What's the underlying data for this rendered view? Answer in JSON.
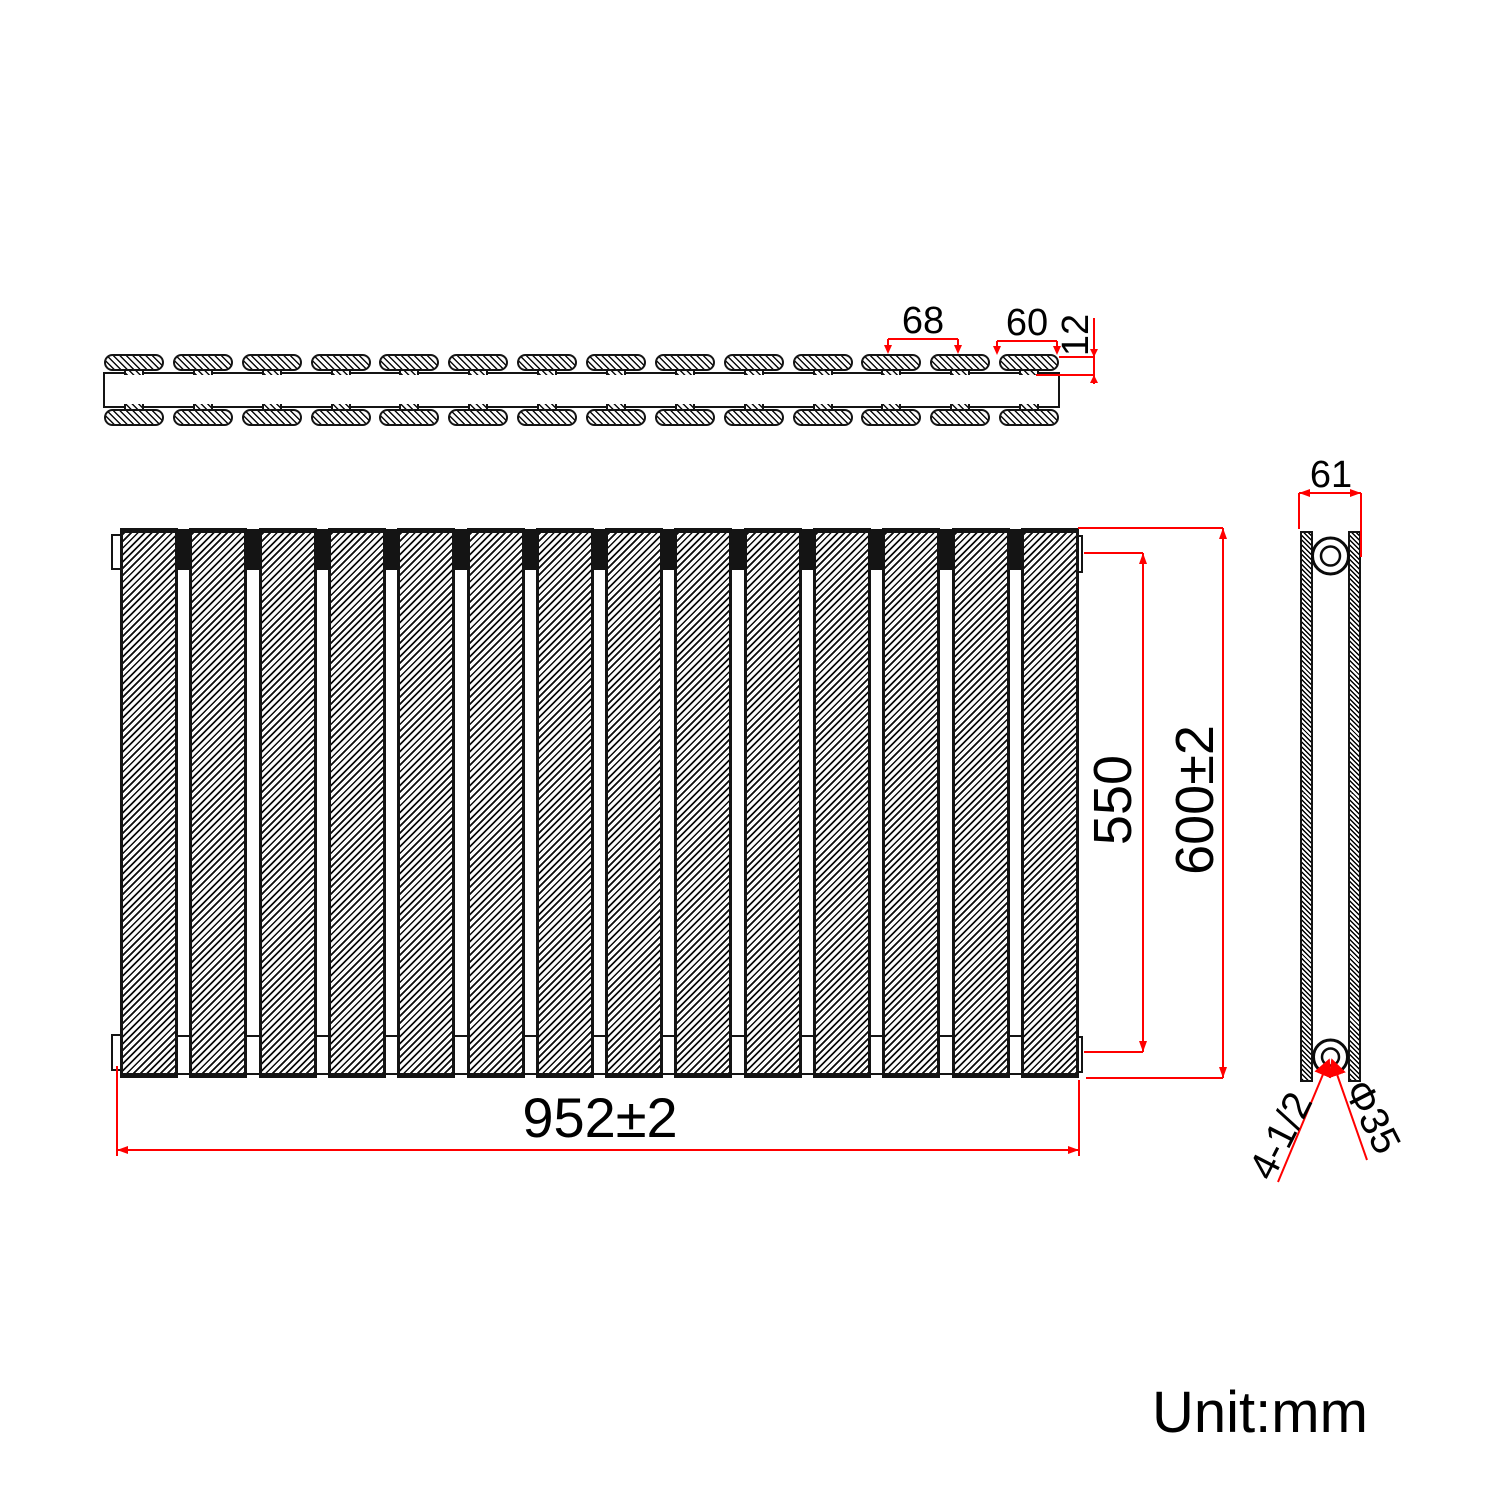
{
  "unit_label": "Unit:mm",
  "colors": {
    "dimension_lines": "#ff0000",
    "drawing_lines": "#141414",
    "background": "#ffffff"
  },
  "top_view": {
    "panel_count": 14,
    "panel_pitch": "68",
    "panel_width": "60",
    "panel_thickness": "12"
  },
  "front_view": {
    "panel_count": 14,
    "overall_width": "952±2",
    "inner_height": "550",
    "overall_height": "600±2"
  },
  "side_view": {
    "depth": "61",
    "connections": "4-1/2",
    "pipe_diameter": "Φ35"
  }
}
